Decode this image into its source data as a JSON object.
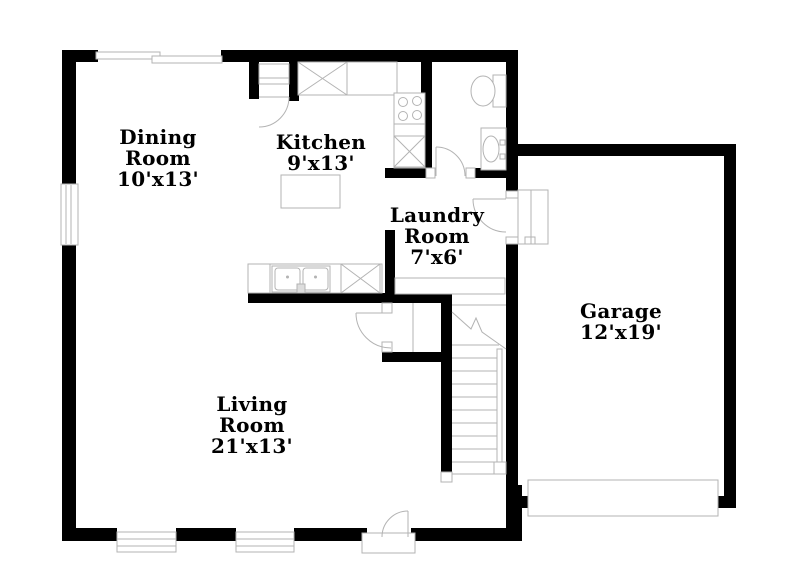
{
  "palette": {
    "wall": "#000000",
    "line": "#b3b3b3",
    "background": "#ffffff",
    "text": "#000000"
  },
  "rooms": {
    "dining": {
      "lines": [
        "Dining",
        "Room",
        "10'x13'"
      ]
    },
    "kitchen": {
      "lines": [
        "Kitchen",
        "9'x13'"
      ]
    },
    "laundry": {
      "lines": [
        "Laundry",
        "Room",
        "7'x6'"
      ]
    },
    "living": {
      "lines": [
        "Living",
        "Room",
        "21'x13'"
      ]
    },
    "garage": {
      "lines": [
        "Garage",
        "12'x19'"
      ]
    }
  },
  "fixtures": [
    "kitchen-island",
    "upper-cabinet",
    "stove",
    "base-cabinet",
    "double-sink",
    "dishwasher",
    "toilet",
    "vanity-sink",
    "washer-dryer-counter",
    "water-heater",
    "stairs",
    "garage-door",
    "front-door",
    "windows"
  ]
}
